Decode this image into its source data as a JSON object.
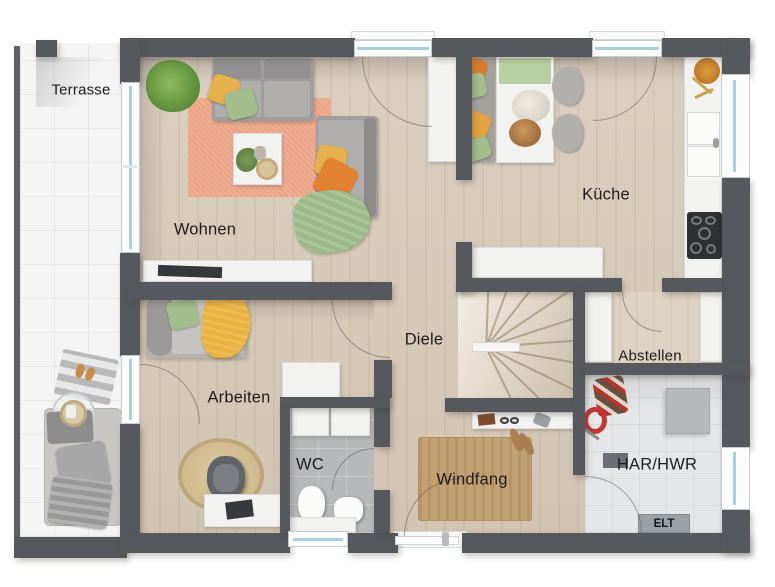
{
  "plan": {
    "type": "floor-plan-top-view",
    "rooms": {
      "terrasse": "Terrasse",
      "wohnen": "Wohnen",
      "kueche": "Küche",
      "diele": "Diele",
      "arbeiten": "Arbeiten",
      "wc": "WC",
      "windfang": "Windfang",
      "abstellen": "Abstellen",
      "har_hwr": "HAR/HWR",
      "elt": "ELT"
    },
    "colors": {
      "wall": "#55595d",
      "wood_floor": "#d8cbba",
      "terrace_tile": "#f4f4f4",
      "wc_tile": "#b6b8ba",
      "utility_tile": "#e4e6e7",
      "living_rug": "#eba285",
      "jute_rug": "#c2a173",
      "accent_green": "#a3bd8c",
      "accent_yellow": "#e5b14d",
      "accent_orange": "#e2812f",
      "window_glass": "#a9cfe3"
    }
  }
}
